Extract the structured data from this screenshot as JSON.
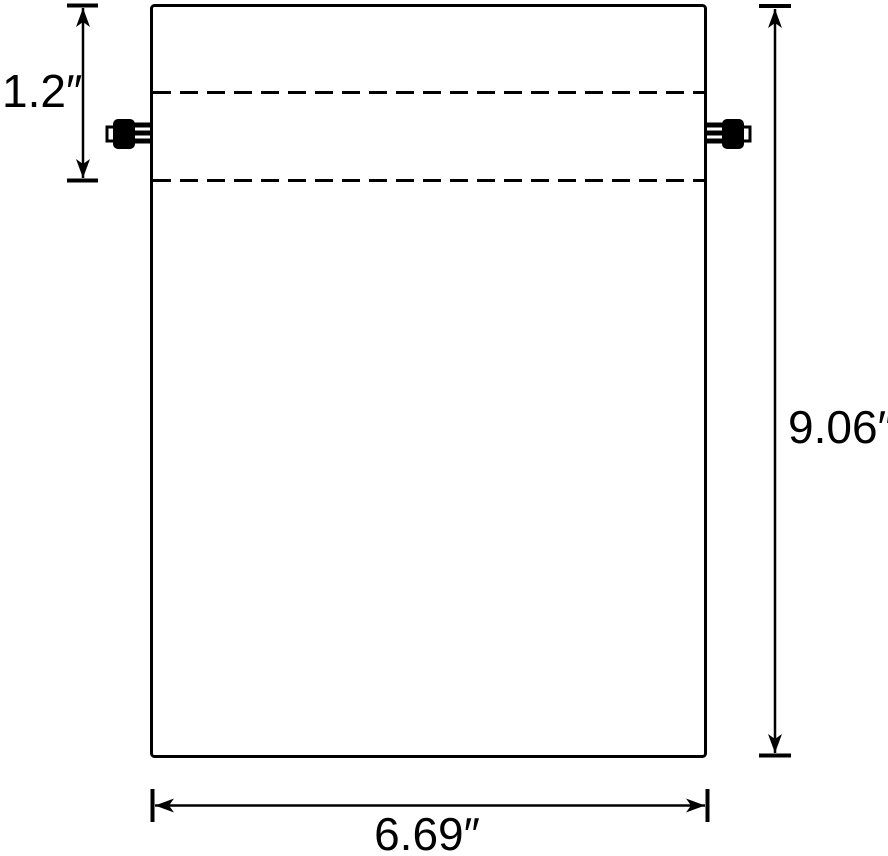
{
  "labels": {
    "hem_height": "1.2″",
    "bag_height": "9.06″",
    "bag_width": "6.69″"
  },
  "colors": {
    "line": "#000000",
    "background": "#ffffff"
  }
}
